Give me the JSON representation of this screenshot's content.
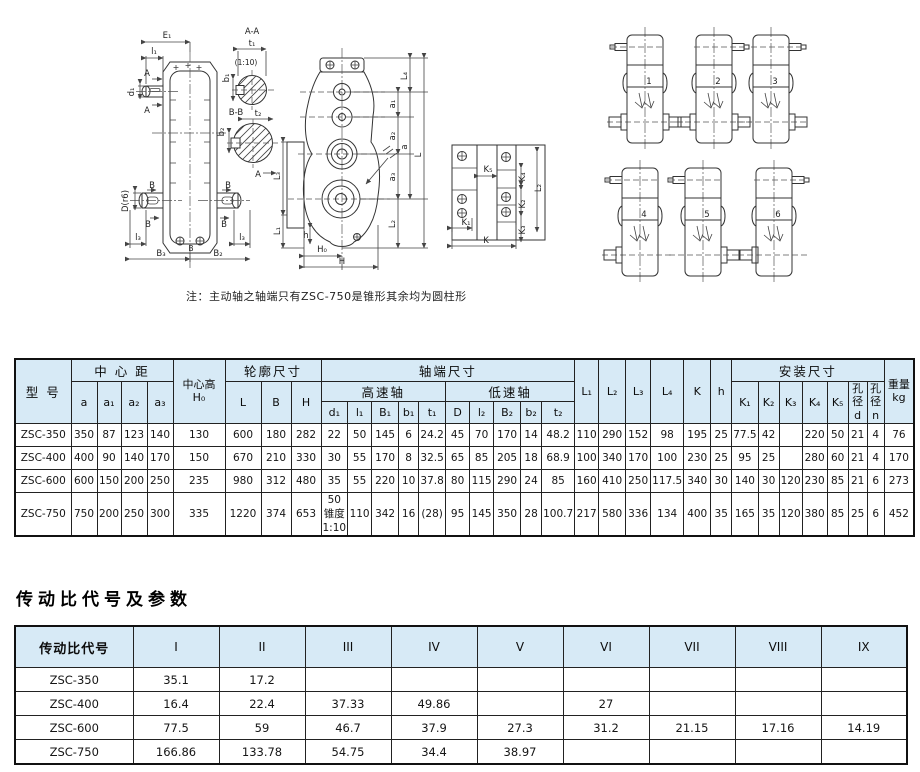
{
  "page": {
    "note": "注：主动轴之轴端只有ZSC-750是锥形其余均为圆柱形",
    "section_title": "传动比代号及参数"
  },
  "colors": {
    "table_header_bg": "#d7eaf6",
    "border": "#222222",
    "line_art": "#333333"
  },
  "drawings": {
    "front": {
      "E1": "E₁",
      "l1": "l₁",
      "A_top": "A",
      "A_bottom": "A",
      "d1": "d₁",
      "D": "D(r6)",
      "B_tl": "B",
      "B_bl": "B",
      "B_tr": "B",
      "B_br": "B",
      "l3_left": "l₃",
      "l3_right": "l₃",
      "B_center": "B",
      "B3": "B₃",
      "B2": "B₂",
      "sec_aa": "A-A",
      "t1": "t₁",
      "b1": "b₁",
      "taper": "(1:10)",
      "sec_bb": "B-B",
      "t2": "t₂",
      "b2": "b₂",
      "A_arrow": "A"
    },
    "side": {
      "L4": "L₄",
      "a1": "a₁",
      "a2": "a₂",
      "a3": "a₃",
      "a": "a",
      "L": "L",
      "L2": "L₂",
      "L3": "L₃",
      "L1": "L₁",
      "h": "h",
      "H0": "H₀",
      "H": "H"
    },
    "plate": {
      "K5": "K₅",
      "K4": "K₄",
      "L2": "L₂",
      "K2": "K₂",
      "K1": "K₁",
      "K3": "K₃",
      "K": "K"
    },
    "arrangements": [
      {
        "num": "1"
      },
      {
        "num": "2"
      },
      {
        "num": "3"
      },
      {
        "num": "4"
      },
      {
        "num": "5"
      },
      {
        "num": "6"
      }
    ]
  },
  "table1": {
    "header": {
      "model": "型 号",
      "center_distance": "中 心 距",
      "a": "a",
      "a1": "a₁",
      "a2": "a₂",
      "a3": "a₃",
      "center_height": "中心高",
      "H0": "H₀",
      "outline": "轮廓尺寸",
      "L": "L",
      "B": "B",
      "H": "H",
      "shaft_end": "轴端尺寸",
      "high_speed": "高速轴",
      "low_speed": "低速轴",
      "d1": "d₁",
      "l1": "l₁",
      "B1": "B₁",
      "b1": "b₁",
      "t1": "t₁",
      "D": "D",
      "l2": "l₂",
      "B2": "B₂",
      "b2": "b₂",
      "t2": "t₂",
      "L1": "L₁",
      "L2": "L₂",
      "L3": "L₃",
      "L4": "L₄",
      "K": "K",
      "h": "h",
      "mounting": "安装尺寸",
      "K1": "K₁",
      "K2": "K₂",
      "K3": "K₃",
      "K4": "K₄",
      "K5": "K₅",
      "bore": "孔径",
      "bore_d": "d",
      "bore_n": "n",
      "weight": "重量",
      "weight_unit": "kg"
    },
    "rows": [
      [
        "ZSC-350",
        "350",
        "87",
        "123",
        "140",
        "130",
        "600",
        "180",
        "282",
        "22",
        "50",
        "145",
        "6",
        "24.2",
        "45",
        "70",
        "170",
        "14",
        "48.2",
        "110",
        "290",
        "152",
        "98",
        "195",
        "25",
        "77.5",
        "42",
        "",
        "220",
        "50",
        "21",
        "4",
        "76"
      ],
      [
        "ZSC-400",
        "400",
        "90",
        "140",
        "170",
        "150",
        "670",
        "210",
        "330",
        "30",
        "55",
        "170",
        "8",
        "32.5",
        "65",
        "85",
        "205",
        "18",
        "68.9",
        "100",
        "340",
        "170",
        "100",
        "230",
        "25",
        "95",
        "25",
        "",
        "280",
        "60",
        "21",
        "4",
        "170"
      ],
      [
        "ZSC-600",
        "600",
        "150",
        "200",
        "250",
        "235",
        "980",
        "312",
        "480",
        "35",
        "55",
        "220",
        "10",
        "37.8",
        "80",
        "115",
        "290",
        "24",
        "85",
        "160",
        "410",
        "250",
        "117.5",
        "340",
        "30",
        "140",
        "30",
        "120",
        "230",
        "85",
        "21",
        "6",
        "273"
      ],
      [
        "ZSC-750",
        "750",
        "200",
        "250",
        "300",
        "335",
        "1220",
        "374",
        "653",
        "50\n锥度\n1:10",
        "110",
        "342",
        "16",
        "(28)",
        "95",
        "145",
        "350",
        "28",
        "100.7",
        "217",
        "580",
        "336",
        "134",
        "400",
        "35",
        "165",
        "35",
        "120",
        "380",
        "85",
        "25",
        "6",
        "452"
      ]
    ]
  },
  "table2": {
    "header": [
      "传动比代号",
      "I",
      "II",
      "III",
      "IV",
      "V",
      "VI",
      "VII",
      "VIII",
      "IX"
    ],
    "rows": [
      [
        "ZSC-350",
        "35.1",
        "17.2",
        "",
        "",
        "",
        "",
        "",
        "",
        ""
      ],
      [
        "ZSC-400",
        "16.4",
        "22.4",
        "37.33",
        "49.86",
        "",
        "27",
        "",
        "",
        ""
      ],
      [
        "ZSC-600",
        "77.5",
        "59",
        "46.7",
        "37.9",
        "27.3",
        "31.2",
        "21.15",
        "17.16",
        "14.19"
      ],
      [
        "ZSC-750",
        "166.86",
        "133.78",
        "54.75",
        "34.4",
        "38.97",
        "",
        "",
        "",
        ""
      ]
    ]
  }
}
